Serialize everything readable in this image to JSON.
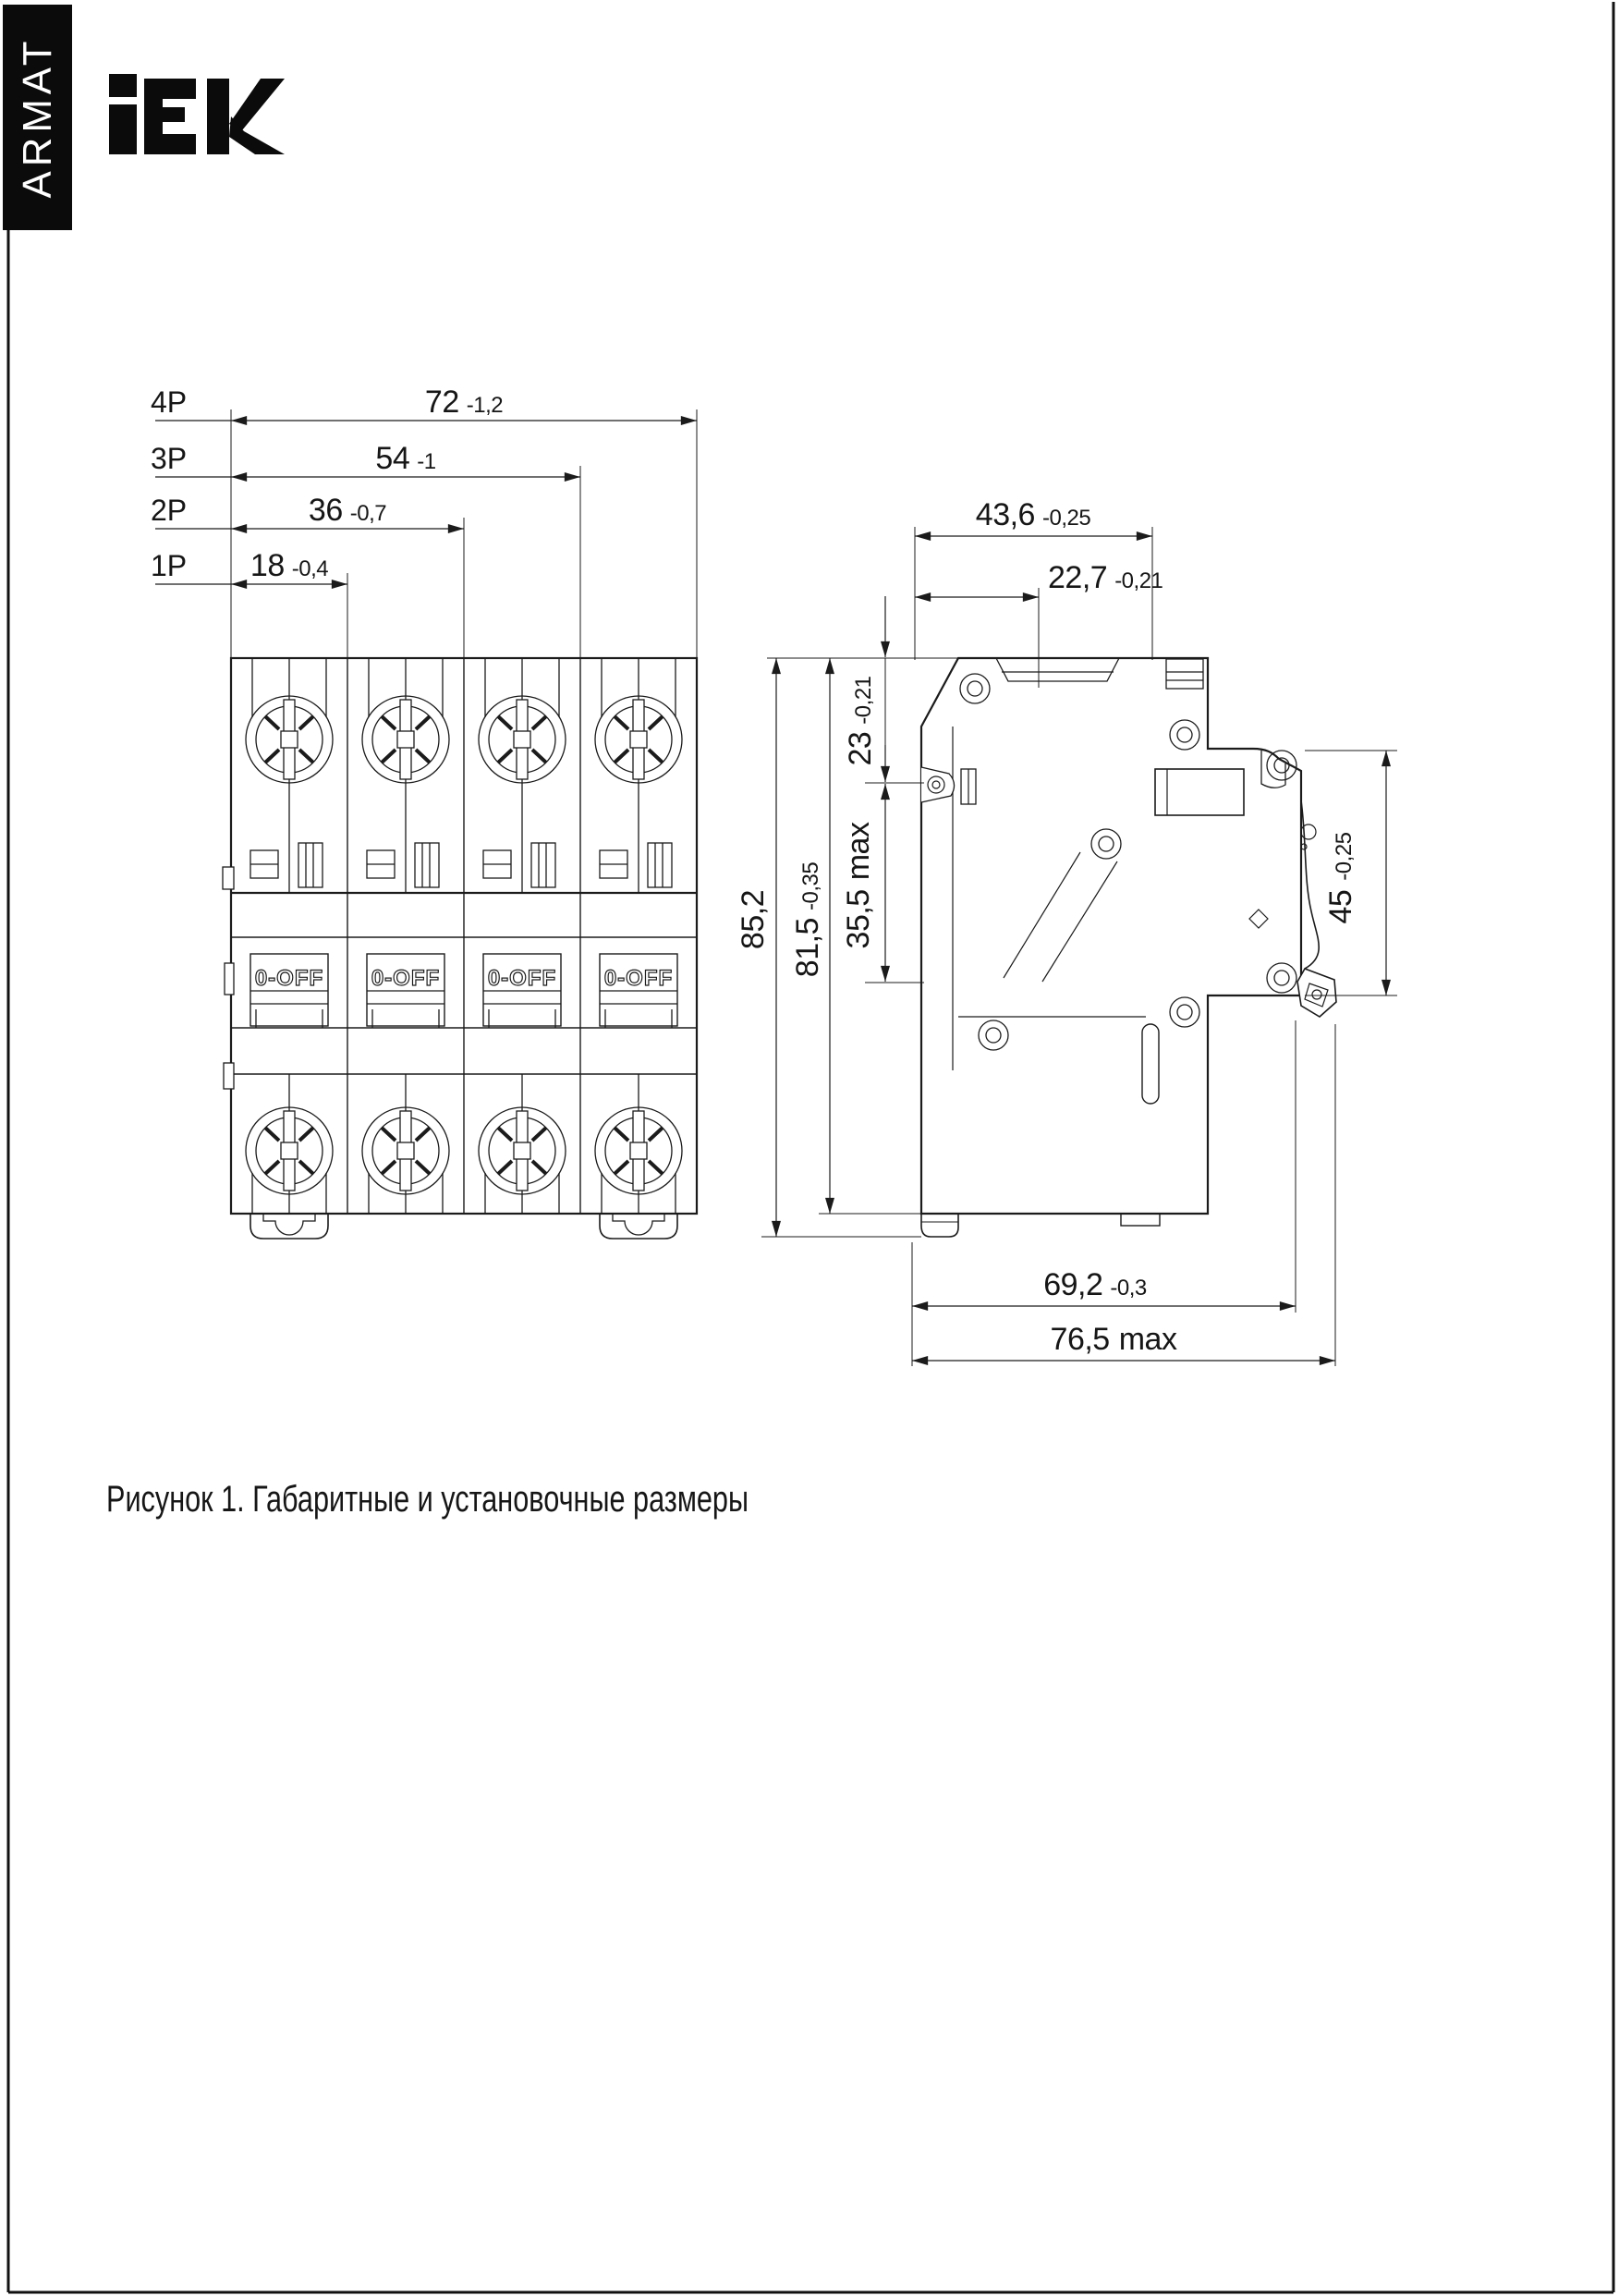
{
  "page": {
    "caption": "Рисунок 1. Габаритные и установочные размеры"
  },
  "brand": {
    "logo_text": "IEK",
    "series_label": "ARMAT",
    "bar_color": "#0b0b0b",
    "line_color": "#1b1b1b"
  },
  "front_view": {
    "toggle_label": "0-OFF",
    "pole_dims": [
      {
        "label": "4P",
        "value": "72",
        "tolerance": "-1,2"
      },
      {
        "label": "3P",
        "value": "54",
        "tolerance": "-1"
      },
      {
        "label": "2P",
        "value": "36",
        "tolerance": "-0,7"
      },
      {
        "label": "1P",
        "value": "18",
        "tolerance": "-0,4"
      }
    ]
  },
  "side_view": {
    "dims": {
      "depth_total": {
        "value": "43,6",
        "tolerance": "-0,25"
      },
      "depth_front": {
        "value": "22,7",
        "tolerance": "-0,21"
      },
      "top_to_terminal": {
        "value": "23",
        "tolerance": "-0,21"
      },
      "terminal_zone": {
        "value": "35,5",
        "suffix": "max"
      },
      "height_total": {
        "value": "85,2"
      },
      "height_body": {
        "value": "81,5",
        "tolerance": "-0,35"
      },
      "din_recess": {
        "value": "45",
        "tolerance": "-0,25"
      },
      "depth_mount": {
        "value": "69,2",
        "tolerance": "-0,3"
      },
      "depth_max": {
        "value": "76,5",
        "suffix": "max"
      }
    }
  }
}
